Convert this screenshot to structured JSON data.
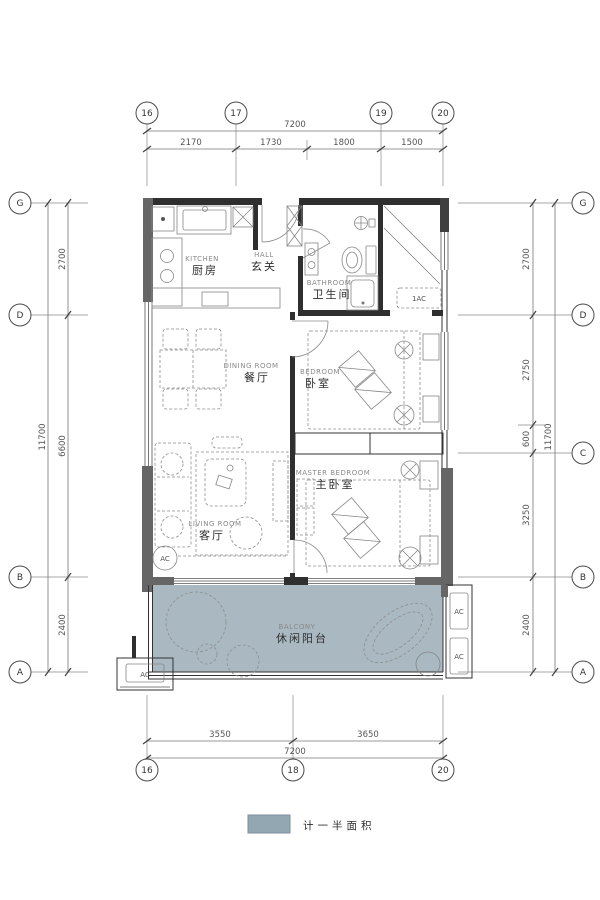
{
  "colors": {
    "balcony_fill": "#a9b8c1",
    "legend_swatch": "#93a7b3"
  },
  "legend": {
    "label": "计一半面积"
  },
  "dims": {
    "top_overall": "7200",
    "top_segments": [
      "2170",
      "1730",
      "1800",
      "1500"
    ],
    "bottom_overall": "7200",
    "bottom_segments": [
      "3550",
      "3650"
    ],
    "left_overall": "11700",
    "left_segments": [
      "2700",
      "6600",
      "2400"
    ],
    "right_overall": "11700",
    "right_segments": [
      "2700",
      "2750",
      "600",
      "3250",
      "2400"
    ]
  },
  "grid_bubbles": {
    "top": [
      "16",
      "17",
      "19",
      "20"
    ],
    "bottom": [
      "16",
      "18",
      "20"
    ],
    "left": [
      "G",
      "D",
      "B",
      "A"
    ],
    "right": [
      "G",
      "D",
      "C",
      "B",
      "A"
    ]
  },
  "rooms": {
    "kitchen": {
      "en": "KITCHEN",
      "zh": "厨房"
    },
    "hall": {
      "en": "HALL",
      "zh": "玄关"
    },
    "bathroom": {
      "en": "BATHROOM",
      "zh": "卫生间"
    },
    "dining": {
      "en": "DINING ROOM",
      "zh": "餐厅"
    },
    "bedroom": {
      "en": "BEDROOM",
      "zh": "卧室"
    },
    "master_bedroom": {
      "en": "MASTER BEDROOM",
      "zh": "主卧室"
    },
    "living": {
      "en": "LIVING ROOM",
      "zh": "客厅"
    },
    "balcony": {
      "en": "BALCONY",
      "zh": "休闲阳台"
    }
  },
  "ac": {
    "closet_unit": "1AC",
    "living_unit": "AC",
    "outdoor_unit": "AC",
    "balcony_unit_top": "AC",
    "balcony_unit_bottom": "AC"
  }
}
